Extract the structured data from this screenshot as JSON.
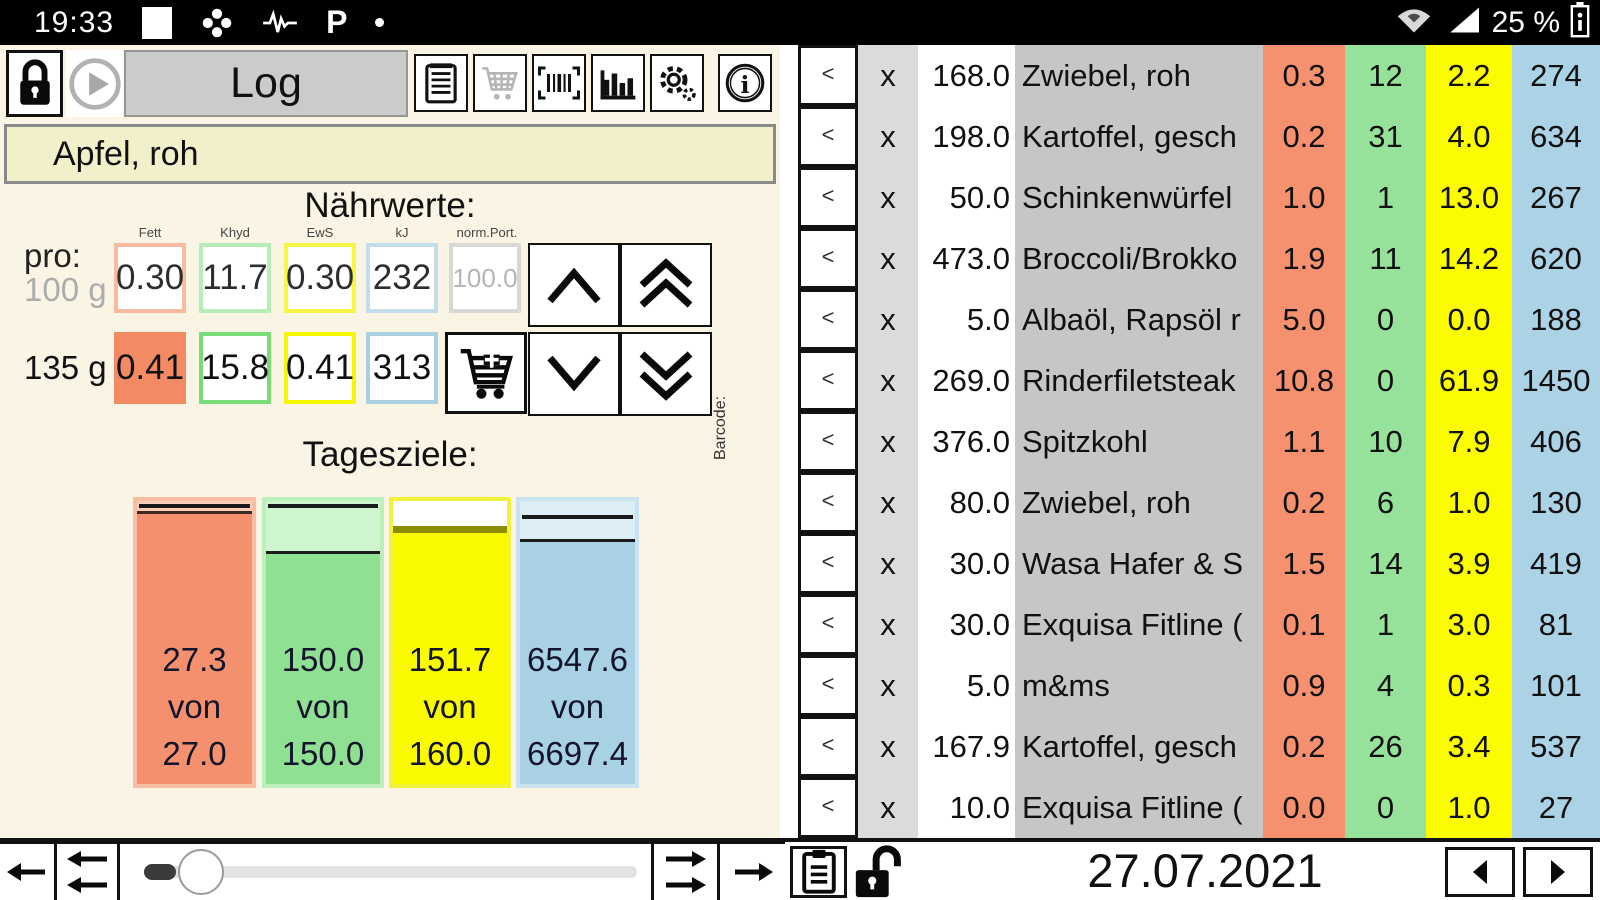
{
  "colors": {
    "salmon": "#F5906E",
    "salmon_pale": "#FACDB7",
    "green": "#90E094",
    "green_pale": "#CFF5CE",
    "yellow": "#FBFB00",
    "yellow_dark": "#8C8C00",
    "blue": "#A9D1E4",
    "blue_pale": "#DCEDF5",
    "cream_bg": "#FAF4E4",
    "input_bg": "#F2F0CB",
    "name_col_grey": "#C6C6C6",
    "x_col_grey": "#DBDBDB",
    "title_grey": "#CBCBCB"
  },
  "status_bar": {
    "time": "19:33",
    "battery_text": "25 %",
    "left_icons": [
      "notification-square",
      "pinwheel",
      "waveform",
      "p-app",
      "dot"
    ],
    "right_icons": [
      "wifi",
      "cell-signal",
      "battery"
    ]
  },
  "toolbar": {
    "title": "Log",
    "buttons": [
      "lock",
      "play",
      "notes",
      "cart",
      "barcode-scan",
      "statistics",
      "settings",
      "info"
    ]
  },
  "food_search": {
    "value": "Apfel, roh"
  },
  "naehrwerte": {
    "heading": "Nährwerte:",
    "pro_label": "pro:",
    "col_labels": {
      "fett": "Fett",
      "khyd": "Khyd",
      "ews": "EwS",
      "kj": "kJ",
      "norm_port": "norm.Port."
    },
    "per_100g": {
      "label": "100 g",
      "fett": "0.30",
      "khyd": "11.7",
      "ews": "0.30",
      "kj": "232",
      "norm_port": "100.0"
    },
    "per_portion": {
      "label": "135 g",
      "fett": "0.41",
      "khyd": "15.8",
      "ews": "0.41",
      "kj": "313"
    },
    "barcode_label": "Barcode:"
  },
  "tagesziele": {
    "heading": "Tagesziele:",
    "bars": [
      {
        "name": "fett",
        "consumed": "27.3",
        "von": "von",
        "goal": "27.0",
        "fill_top_pct": 3.5,
        "goal_line_pct": 1.2
      },
      {
        "name": "khyd",
        "consumed": "150.0",
        "von": "von",
        "goal": "150.0",
        "fill_top_pct": 17.5,
        "goal_line_pct": 1.2
      },
      {
        "name": "ews",
        "consumed": "151.7",
        "von": "von",
        "goal": "160.0",
        "fill_top_pct": 9,
        "goal_line_pct": -1
      },
      {
        "name": "kj",
        "consumed": "6547.6",
        "von": "von",
        "goal": "6697.4",
        "fill_top_pct": 13.5,
        "goal_line_pct": 5
      }
    ]
  },
  "log_table": {
    "back_label": "<",
    "remove_label": "x",
    "rows": [
      {
        "amount": "168.0",
        "name": "Zwiebel, roh",
        "fett": "0.3",
        "khyd": "12",
        "ews": "2.2",
        "kj": "274"
      },
      {
        "amount": "198.0",
        "name": "Kartoffel, gesch",
        "fett": "0.2",
        "khyd": "31",
        "ews": "4.0",
        "kj": "634"
      },
      {
        "amount": "50.0",
        "name": "Schinkenwürfel",
        "fett": "1.0",
        "khyd": "1",
        "ews": "13.0",
        "kj": "267"
      },
      {
        "amount": "473.0",
        "name": "Broccoli/Brokko",
        "fett": "1.9",
        "khyd": "11",
        "ews": "14.2",
        "kj": "620"
      },
      {
        "amount": "5.0",
        "name": "Albaöl, Rapsöl r",
        "fett": "5.0",
        "khyd": "0",
        "ews": "0.0",
        "kj": "188"
      },
      {
        "amount": "269.0",
        "name": "Rinderfiletsteak",
        "fett": "10.8",
        "khyd": "0",
        "ews": "61.9",
        "kj": "1450"
      },
      {
        "amount": "376.0",
        "name": "Spitzkohl",
        "fett": "1.1",
        "khyd": "10",
        "ews": "7.9",
        "kj": "406"
      },
      {
        "amount": "80.0",
        "name": "Zwiebel, roh",
        "fett": "0.2",
        "khyd": "6",
        "ews": "1.0",
        "kj": "130"
      },
      {
        "amount": "30.0",
        "name": "Wasa Hafer & S",
        "fett": "1.5",
        "khyd": "14",
        "ews": "3.9",
        "kj": "419"
      },
      {
        "amount": "30.0",
        "name": "Exquisa Fitline (",
        "fett": "0.1",
        "khyd": "1",
        "ews": "3.0",
        "kj": "81"
      },
      {
        "amount": "5.0",
        "name": "m&ms",
        "fett": "0.9",
        "khyd": "4",
        "ews": "0.3",
        "kj": "101"
      },
      {
        "amount": "167.9",
        "name": "Kartoffel, gesch",
        "fett": "0.2",
        "khyd": "26",
        "ews": "3.4",
        "kj": "537"
      },
      {
        "amount": "10.0",
        "name": "Exquisa Fitline (",
        "fett": "0.0",
        "khyd": "0",
        "ews": "1.0",
        "kj": "27"
      }
    ]
  },
  "bottom_bar": {
    "date": "27.07.2021",
    "slider_thumb_pct": 11
  }
}
